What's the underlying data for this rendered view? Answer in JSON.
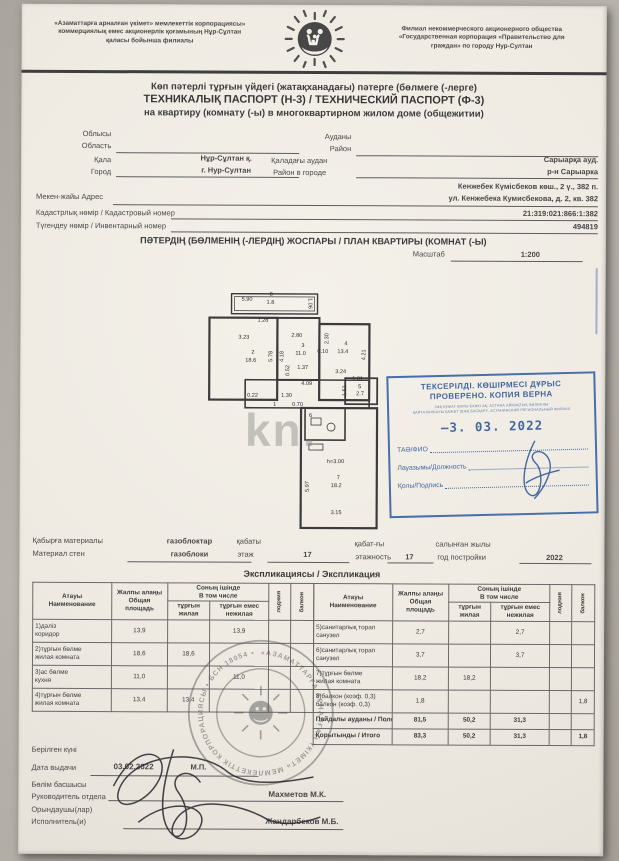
{
  "header": {
    "left_org": "«Азаматтарға арналған үкімет» мемлекеттік корпорациясы»\nкоммерциялық емес акционерлік қоғамының Нұр-Сұлтан\nқаласы бойынша филиалы",
    "right_org": "Филиал некоммерческого акционерного общества\n«Государственная корпорация «Правительство для\nграждан» по городу Нур-Султан",
    "logo": "family-hand-sun-logo"
  },
  "title": {
    "line1": "Көп пәтерлі тұрғын үйдегі (жатақханадағы) пәтерге (бөлмеге (-лерге)",
    "line2": "ТЕХНИКАЛЫҚ ПАСПОРТ (Н-3) / ТЕХНИЧЕСКИЙ ПАСПОРТ (Ф-3)",
    "line3": "на квартиру (комнату (-ы) в многоквартирном жилом доме (общежитии)"
  },
  "fields": {
    "oblast_kk": "Облысы",
    "oblast_ru": "Область",
    "oblast_value": "",
    "raion_kk": "Ауданы",
    "raion_ru": "Район",
    "raion_value": "",
    "city_kk": "Қала",
    "city_ru": "Город",
    "city_value_kk": "Нұр-Сұлтан қ.",
    "city_value_ru": "г. Нур-Султан",
    "district_kk": "Қаладағы аудан",
    "district_ru": "Район в городе",
    "district_value_kk": "Сарыарқа ауд.",
    "district_value_ru": "р-н Сарыарка",
    "address_label": "Мекен-жайы Адрес",
    "address_value_kk": "Кенжебек Күмісбеков көш., 2 ү., 382 п.",
    "address_value_ru": "ул. Кенжебека Кумисбекова, д. 2, кв. 382",
    "cadastral_label": "Кадастрлық нөмір / Кадастровый номер",
    "cadastral_value": "21:319:021:866:1:382",
    "inventory_label": "Түгендеу нөмір / Инвентарный номер",
    "inventory_value": "494819"
  },
  "plan": {
    "section_title": "ПӘТЕРДІҢ (БӨЛМЕНІҢ (-ЛЕРДІҢ) ЖОСПАРЫ / ПЛАН КВАРТИРЫ (КОМНАТ (-Ы)",
    "scale_label": "Масштаб",
    "scale_value": "1:200",
    "watermark": "kn.",
    "labels": [
      {
        "t": "5.90",
        "x": 36,
        "y": 6
      },
      {
        "t": "8",
        "x": 64,
        "y": 1
      },
      {
        "t": "1.8",
        "x": 61,
        "y": 9
      },
      {
        "t": "1.06",
        "x": 106,
        "y": 6,
        "r": 90
      },
      {
        "t": "1.28",
        "x": 52,
        "y": 27
      },
      {
        "t": "3.23",
        "x": 33,
        "y": 44
      },
      {
        "t": "2",
        "x": 46,
        "y": 59
      },
      {
        "t": "18.6",
        "x": 40,
        "y": 67
      },
      {
        "t": "5.78",
        "x": 64,
        "y": 70,
        "r": -90
      },
      {
        "t": "2.80",
        "x": 86,
        "y": 42
      },
      {
        "t": "4.18",
        "x": 75,
        "y": 70,
        "r": -90
      },
      {
        "t": "3",
        "x": 96,
        "y": 52
      },
      {
        "t": "11.0",
        "x": 90,
        "y": 60
      },
      {
        "t": "0.52",
        "x": 81,
        "y": 84,
        "r": -90
      },
      {
        "t": "1.37",
        "x": 92,
        "y": 74
      },
      {
        "t": "2.30",
        "x": 120,
        "y": 52,
        "r": -90
      },
      {
        "t": "0.10",
        "x": 112,
        "y": 58
      },
      {
        "t": "4",
        "x": 139,
        "y": 50
      },
      {
        "t": "13.4",
        "x": 132,
        "y": 58
      },
      {
        "t": "4.21",
        "x": 157,
        "y": 68,
        "r": -90
      },
      {
        "t": "3.24",
        "x": 130,
        "y": 78
      },
      {
        "t": "4.09",
        "x": 96,
        "y": 90
      },
      {
        "t": "0.22",
        "x": 42,
        "y": 102
      },
      {
        "t": "1.30",
        "x": 76,
        "y": 102
      },
      {
        "t": "1",
        "x": 68,
        "y": 111
      },
      {
        "t": "0.70",
        "x": 87,
        "y": 111
      },
      {
        "t": "1.81",
        "x": 147,
        "y": 85
      },
      {
        "t": "1.51",
        "x": 138,
        "y": 104,
        "r": -90
      },
      {
        "t": "5",
        "x": 153,
        "y": 93
      },
      {
        "t": "2.7",
        "x": 151,
        "y": 100
      },
      {
        "t": "6",
        "x": 104,
        "y": 122
      },
      {
        "t": "h=3.00",
        "x": 122,
        "y": 168
      },
      {
        "t": "7",
        "x": 132,
        "y": 184
      },
      {
        "t": "18.2",
        "x": 126,
        "y": 192
      },
      {
        "t": "5.97",
        "x": 101,
        "y": 200,
        "r": -90
      },
      {
        "t": "3.15",
        "x": 126,
        "y": 219
      }
    ]
  },
  "stamp": {
    "title1": "ТЕКСЕРІЛДІ. КӨШІРМЕСІ ДҰРЫС",
    "title2": "ПРОВЕРЕНО. КОПИЯ ВЕРНА",
    "small1": "ЗФҚ ҚҰЖАТ ҚОРЫ БАНКІ АҚ, АСТАНА АЙМАҚТЫҚ ФИЛИАЛЫ",
    "small2": "ҚАЙТАЛАНБАУЫ ҚАЖЕТ ШЖҚ БАСҚАРУ, АСТАНИНСКИЙ РЕГИОНАЛЬНЫЙ ФИЛИАЛ",
    "date_dash": "–",
    "date": "3. 03. 2022",
    "row1": "ТАӘ/ФИО",
    "row2": "Лауазымы/Должность",
    "row3": "Қолы/Подпись"
  },
  "building": {
    "wall_kk": "Қабырға материалы",
    "wall_ru": "Материал стен",
    "wall_value_kk": "газоблоктар",
    "wall_value_ru": "газоблоки",
    "floor_kk": "қабаты",
    "floor_ru": "этаж",
    "floor_value": "17",
    "floors_kk": "қабат-ғы",
    "floors_ru": "этажность",
    "floors_value": "17",
    "year_kk": "салынған жылы",
    "year_ru": "год постройки",
    "year_value": "2022"
  },
  "explication": {
    "section_title": "Экспликациясы / Экспликация",
    "headers": {
      "name": "Атауы\nНаименование",
      "total": "Жалпы алаңы\nОбщая площадь",
      "including": "Соның ішінде\nВ том числе",
      "living": "тұрғын\nжилая",
      "nonliving": "тұрғын емес\nнежилая",
      "loggia": "лоджия",
      "balcony": "балкон"
    },
    "left_rows": [
      {
        "name": "1)дәліз\nкоридор",
        "v": [
          "13,9",
          "",
          "13,9",
          "",
          ""
        ]
      },
      {
        "name": "2)тұрғын бөлме\nжилая комната",
        "v": [
          "18,6",
          "18,6",
          "",
          "",
          ""
        ]
      },
      {
        "name": "3)ас бөлме\nкухня",
        "v": [
          "11,0",
          "",
          "11,0",
          "",
          ""
        ]
      },
      {
        "name": "4)тұрғын бөлме\nжилая комната",
        "v": [
          "13,4",
          "13,4",
          "",
          "",
          ""
        ]
      }
    ],
    "right_rows": [
      {
        "name": "5)санитарлық торап\nсанузел",
        "v": [
          "2,7",
          "",
          "2,7",
          "",
          ""
        ]
      },
      {
        "name": "6)санитарлық торап\nсанузел",
        "v": [
          "3,7",
          "",
          "3,7",
          "",
          ""
        ]
      },
      {
        "name": "7)тұрғын бөлме\nжилая комната",
        "v": [
          "18,2",
          "18,2",
          "",
          "",
          ""
        ]
      },
      {
        "name": "8)балкон (коэф. 0,3)\nбалкон (коэф. 0,3)",
        "v": [
          "1,8",
          "",
          "",
          "",
          "1,8"
        ]
      }
    ],
    "summary_rows": [
      {
        "name": "Пайдалы ауданы / Полезная площадь",
        "v": [
          "81,5",
          "50,2",
          "31,3",
          "",
          ""
        ]
      },
      {
        "name": "Қорытынды / Итого",
        "v": [
          "83,3",
          "50,2",
          "31,3",
          "",
          "1,8"
        ]
      }
    ]
  },
  "seal": {
    "ring_text": "«АЗАМАТТАРҒА АРНАЛҒАН ҮКІМЕТ» МЕМЛЕКЕТТІК КОРПОРАЦИЯСЫ • БСН 18054 • КОММЕРЦИЯЛЫҚ ЕМЕС АКЦИОНЕРЛІК ҚОҒАМЫ •"
  },
  "footer": {
    "issued_kk": "Берілген күні",
    "issued_ru": "Дата выдачи",
    "issued_value": "03.02.2022",
    "mp": "М.П.",
    "head_kk": "Бөлім басшысы",
    "head_ru": "Руководитель отдела",
    "head_name": "Махметов М.К.",
    "executor_kk": "Орындаушы(лар)",
    "executor_ru": "Исполнитель(и)",
    "executor_name": "Жандарбеков М.Б."
  }
}
